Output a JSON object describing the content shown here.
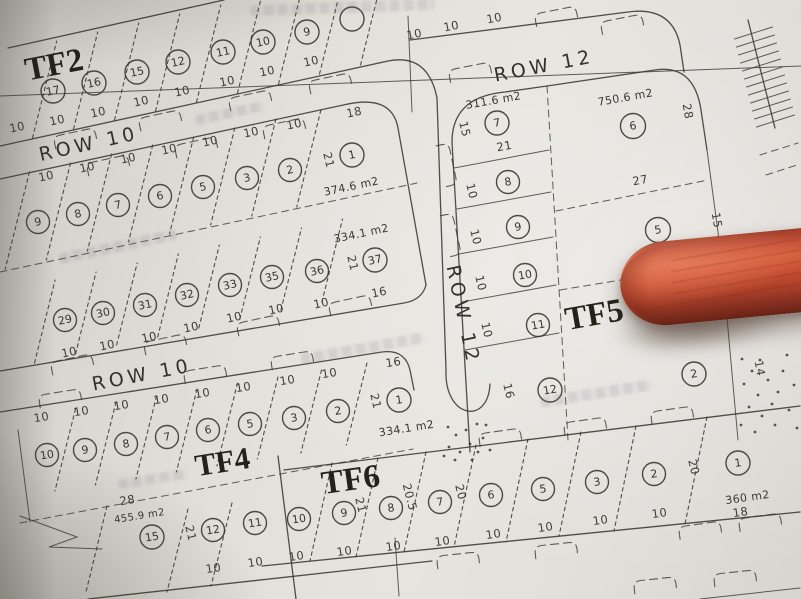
{
  "scene": {
    "description": "Photograph of a paper subdivision plat map; a red pen tip points at block TF5",
    "paper_color": "#ddd9d4",
    "ink_color": "#3b382f",
    "pen_color": "#c24b31"
  },
  "streets": {
    "row10_upper": "ROW 10",
    "row10_lower": "ROW 10",
    "row12_top": "ROW 12",
    "row12_vertical": "ROW 12"
  },
  "dims": {
    "ten": "10"
  },
  "blocks": {
    "tf2": {
      "label": "TF2",
      "lots": [
        "17",
        "16",
        "15",
        "12",
        "11",
        "10",
        "9"
      ]
    },
    "blockA": {
      "lots": [
        "9",
        "8",
        "7",
        "6",
        "5",
        "3",
        "2",
        "1"
      ],
      "lot1_top_dim": "18",
      "lot1_side_dim": "21",
      "lot1_area": "374.6 m2"
    },
    "blockB": {
      "lots": [
        "29",
        "30",
        "31",
        "32",
        "33",
        "35",
        "36",
        "37"
      ],
      "lot37_area": "334.1 m2",
      "lot37_side_dim": "21",
      "lot37_bottom_dim": "16"
    },
    "tf4": {
      "label": "TF4",
      "lots": [
        "10",
        "9",
        "8",
        "7",
        "6",
        "5",
        "3",
        "2",
        "1"
      ],
      "lot1_top_dim": "16",
      "lot1_side_dim": "21",
      "lot1_area": "334.1 m2",
      "lower_lots": [
        "15",
        "12",
        "11"
      ],
      "lot15_area": "455.9 m2",
      "lot15_top_dim": "28",
      "lot15_side_dim": "21"
    },
    "tf6": {
      "label": "TF6",
      "lots": [
        "10",
        "9",
        "8",
        "7",
        "6",
        "5",
        "3",
        "2",
        "1"
      ],
      "lot9_side_dim": "21",
      "lot8_side_dim": "20.5",
      "lot7_side_dim": "20",
      "lot1_side_dim": "20",
      "lot1_area": "360 m2",
      "lot1_bottom_dim": "18"
    },
    "tf5": {
      "label": "TF5",
      "west_lots": [
        "7",
        "8",
        "9",
        "10",
        "11",
        "12"
      ],
      "lot7_area": "311.6 m2",
      "lot7_side_dim": "15",
      "lot7_bottom_dim": "21",
      "lot12_side_dim": "16",
      "east_lots": [
        "6",
        "5",
        "2"
      ],
      "lot6_area": "750.6 m2",
      "lot6_side_dim": "28",
      "lot6_bottom_dim": "27",
      "lot5_side_dim": "15",
      "lot2_side_dim": "14"
    }
  }
}
